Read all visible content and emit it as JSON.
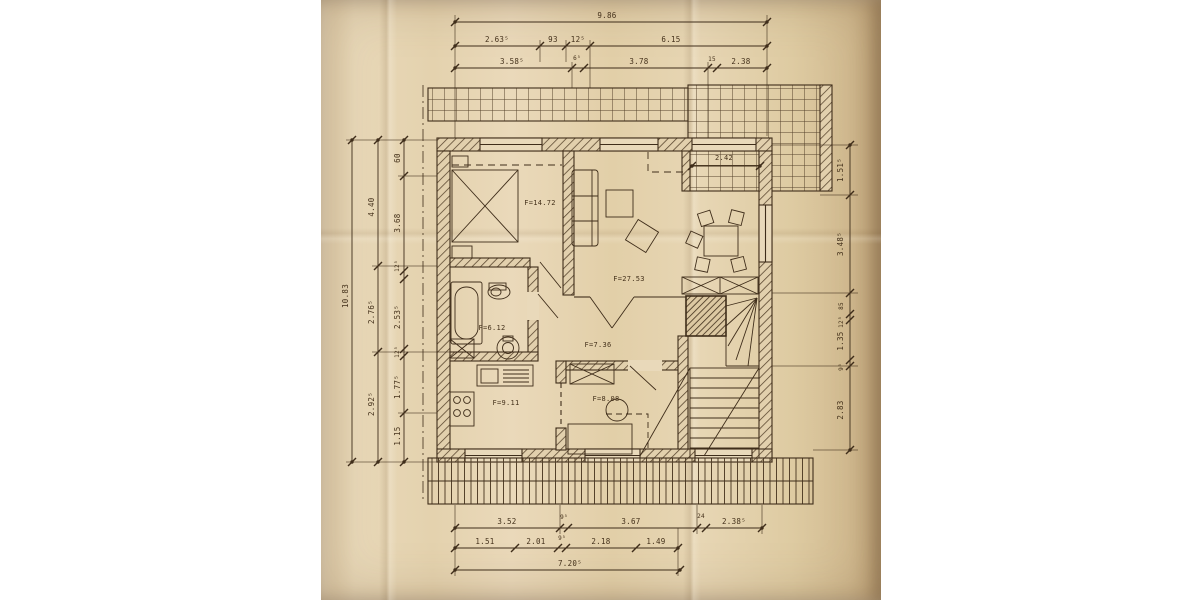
{
  "document": {
    "type": "scanned architectural floor plan (attic storey) on aged paper",
    "units_note": "dimensions in meters"
  },
  "colors": {
    "background": "#ffffff",
    "paper": "#e6d5b4",
    "paper_dark": "#d3bd96",
    "ink": "#3f2d1a",
    "text": "#44311b"
  },
  "plan": {
    "room_labels": [
      {
        "text": "F=14.72",
        "x": 540,
        "y": 205,
        "size": 7
      },
      {
        "text": "F=27.53",
        "x": 629,
        "y": 281,
        "size": 7
      },
      {
        "text": "2.42",
        "x": 724,
        "y": 160,
        "size": 7
      },
      {
        "text": "F=6.12",
        "x": 492,
        "y": 330,
        "size": 7
      },
      {
        "text": "F=7.36",
        "x": 598,
        "y": 347,
        "size": 7
      },
      {
        "text": "F=9.11",
        "x": 506,
        "y": 405,
        "size": 7
      },
      {
        "text": "F=8.08",
        "x": 606,
        "y": 401,
        "size": 7
      }
    ],
    "dimensions": {
      "top": [
        {
          "text": "9.86",
          "x": 607,
          "y": 18
        },
        {
          "text": "2.63⁵",
          "x": 497,
          "y": 42
        },
        {
          "text": "93",
          "x": 553,
          "y": 42
        },
        {
          "text": "12⁵",
          "x": 578,
          "y": 42
        },
        {
          "text": "6.15",
          "x": 671,
          "y": 42
        },
        {
          "text": "3.58⁵",
          "x": 512,
          "y": 64
        },
        {
          "text": "6⁵",
          "x": 577,
          "y": 60,
          "size": 6
        },
        {
          "text": "3.78",
          "x": 639,
          "y": 64
        },
        {
          "text": "15",
          "x": 712,
          "y": 61,
          "size": 6
        },
        {
          "text": "2.38",
          "x": 741,
          "y": 64
        }
      ],
      "bottom": [
        {
          "text": "3.52",
          "x": 507,
          "y": 524
        },
        {
          "text": "9⁵",
          "x": 564,
          "y": 519,
          "size": 6
        },
        {
          "text": "3.67",
          "x": 631,
          "y": 524
        },
        {
          "text": "24",
          "x": 701,
          "y": 518,
          "size": 6
        },
        {
          "text": "2.38⁵",
          "x": 734,
          "y": 524
        },
        {
          "text": "1.51",
          "x": 485,
          "y": 544
        },
        {
          "text": "2.01",
          "x": 536,
          "y": 544
        },
        {
          "text": "9⁵",
          "x": 562,
          "y": 540,
          "size": 6
        },
        {
          "text": "2.18",
          "x": 601,
          "y": 544
        },
        {
          "text": "1.49",
          "x": 656,
          "y": 544
        },
        {
          "text": "7.20⁵",
          "x": 570,
          "y": 566
        }
      ],
      "left": [
        {
          "text": "10.83",
          "x": 348,
          "y": 296,
          "rot": -90
        },
        {
          "text": "4.40",
          "x": 374,
          "y": 207,
          "rot": -90
        },
        {
          "text": "2.76⁵",
          "x": 374,
          "y": 312,
          "rot": -90
        },
        {
          "text": "2.92⁵",
          "x": 374,
          "y": 404,
          "rot": -90
        },
        {
          "text": "60",
          "x": 400,
          "y": 158,
          "rot": -90
        },
        {
          "text": "3.68",
          "x": 400,
          "y": 223,
          "rot": -90
        },
        {
          "text": "12⁵",
          "x": 399,
          "y": 266,
          "rot": -90,
          "size": 6
        },
        {
          "text": "2.53⁵",
          "x": 400,
          "y": 317,
          "rot": -90
        },
        {
          "text": "12⁵",
          "x": 399,
          "y": 352,
          "rot": -90,
          "size": 6
        },
        {
          "text": "1.77⁵",
          "x": 400,
          "y": 387,
          "rot": -90
        },
        {
          "text": "1.15",
          "x": 400,
          "y": 436,
          "rot": -90
        }
      ],
      "right": [
        {
          "text": "1.51⁵",
          "x": 843,
          "y": 170,
          "rot": -90
        },
        {
          "text": "3.48⁵",
          "x": 843,
          "y": 244,
          "rot": -90
        },
        {
          "text": "85",
          "x": 843,
          "y": 306,
          "rot": -90,
          "size": 6
        },
        {
          "text": "12⁵",
          "x": 843,
          "y": 322,
          "rot": -90,
          "size": 6
        },
        {
          "text": "1.35",
          "x": 843,
          "y": 341,
          "rot": -90
        },
        {
          "text": "9⁵",
          "x": 843,
          "y": 367,
          "rot": -90,
          "size": 6
        },
        {
          "text": "2.83",
          "x": 843,
          "y": 410,
          "rot": -90
        }
      ]
    }
  }
}
